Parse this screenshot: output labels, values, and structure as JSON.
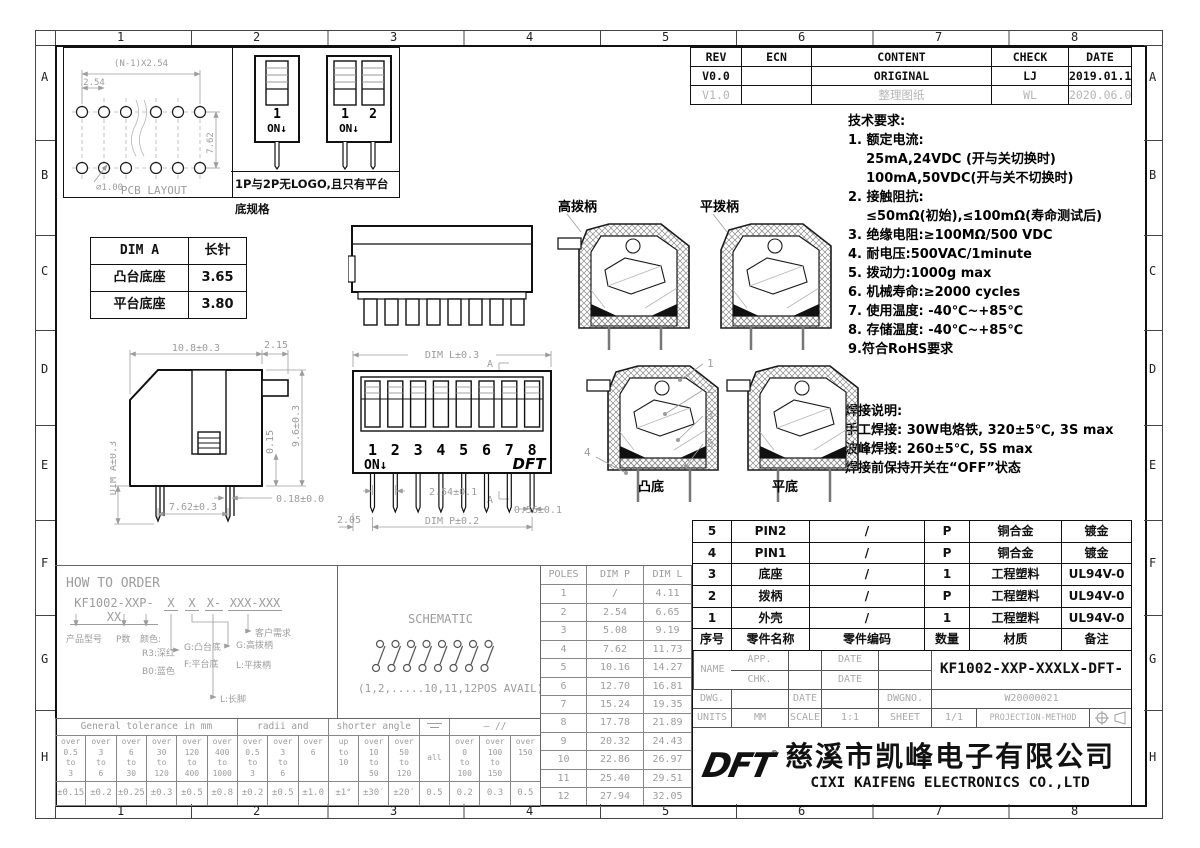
{
  "frame": {
    "cols": [
      "1",
      "2",
      "3",
      "4",
      "5",
      "6",
      "7",
      "8"
    ],
    "rows": [
      "A",
      "B",
      "C",
      "D",
      "E",
      "F",
      "G",
      "H"
    ]
  },
  "revision_table": {
    "headers": [
      "REV",
      "ECN",
      "CONTENT",
      "CHECK",
      "DATE"
    ],
    "rows": [
      {
        "rev": "V0.0",
        "ecn": "",
        "content": "ORIGINAL",
        "check": "LJ",
        "date": "2019.01.13"
      },
      {
        "rev": "V1.0",
        "ecn": "",
        "content": "整理图纸",
        "check": "WL",
        "date": "2020.06.03"
      }
    ]
  },
  "pcb_layout": {
    "dim_span": "(N-1)X2.54",
    "dim_pitch": "2.54",
    "dim_row": "7.62",
    "dim_hole": "⌀1.00",
    "caption": "PCB LAYOUT"
  },
  "mini_switches": {
    "sw1_num": "1",
    "sw2_num1": "1",
    "sw2_num2": "2",
    "on_label": "ON↓",
    "note": "1P与2P无LOGO,且只有平台底规格"
  },
  "dim_a_table": {
    "h1": "DIM A",
    "h2": "长针",
    "rows": [
      [
        "凸台底座",
        "3.65"
      ],
      [
        "平台底座",
        "3.80"
      ]
    ]
  },
  "tech": {
    "title": "技术要求:",
    "lines": [
      "1. 额定电流:",
      "    25mA,24VDC (开与关切换时)",
      "    100mA,50VDC(开与关不切换时)",
      "2. 接触阻抗:",
      "    ≤50mΩ(初始),≤100mΩ(寿命测试后)",
      "3. 绝缘电阻:≥100MΩ/500 VDC",
      "4. 耐电压:500VAC/1minute",
      "5. 拨动力:1000g max",
      "6. 机械寿命:≥2000 cycles",
      "7. 使用温度: -40℃~+85℃",
      "8. 存储温度: -40℃~+85℃",
      "9.符合RoHS要求"
    ]
  },
  "solder": {
    "title": "焊接说明:",
    "lines": [
      "手工焊接: 30W电烙铁, 320±5℃, 3S max",
      "波峰焊接: 260±5℃, 5S max",
      "焊接前保持开关在“OFF”状态"
    ]
  },
  "sections": {
    "high_label": "高拨柄",
    "flat_label": "平拨柄",
    "convex_label": "凸底",
    "flatbottom_label": "平底",
    "callouts": [
      "1",
      "2",
      "3",
      "4",
      "5"
    ]
  },
  "side_view": {
    "d_width": "10.8±0.3",
    "d_stub": "2.15",
    "d_height": "9.6±0.3",
    "d_step": "0.15",
    "d_pin_t": "0.18±0.05",
    "d_pitch": "7.62±0.3",
    "d_pinlen": "DIM A±0.3"
  },
  "front_view": {
    "top_dim": "DIM L±0.3",
    "positions": [
      "1",
      "2",
      "3",
      "4",
      "5",
      "6",
      "7",
      "8"
    ],
    "on_label": "ON↓",
    "section_a": "A",
    "pitch_dim": "2.54±0.1",
    "pin_w_dim": "0.56±0.1",
    "p_dim": "DIM P±0.2",
    "left_dim": "2.05",
    "logo": "DFT"
  },
  "bom": {
    "headers": [
      "序号",
      "零件名称",
      "零件编码",
      "数量",
      "材质",
      "备注"
    ],
    "rows": [
      [
        "5",
        "PIN2",
        "/",
        "P",
        "铜合金",
        "镀金"
      ],
      [
        "4",
        "PIN1",
        "/",
        "P",
        "铜合金",
        "镀金"
      ],
      [
        "3",
        "底座",
        "/",
        "1",
        "工程塑料",
        "UL94V-0"
      ],
      [
        "2",
        "拨柄",
        "/",
        "P",
        "工程塑料",
        "UL94V-0"
      ],
      [
        "1",
        "外壳",
        "/",
        "1",
        "工程塑料",
        "UL94V-0"
      ]
    ]
  },
  "poles_table": {
    "headers": [
      "POLES",
      "DIM P",
      "DIM L"
    ],
    "rows": [
      [
        "1",
        "/",
        "4.11"
      ],
      [
        "2",
        "2.54",
        "6.65"
      ],
      [
        "3",
        "5.08",
        "9.19"
      ],
      [
        "4",
        "7.62",
        "11.73"
      ],
      [
        "5",
        "10.16",
        "14.27"
      ],
      [
        "6",
        "12.70",
        "16.81"
      ],
      [
        "7",
        "15.24",
        "19.35"
      ],
      [
        "8",
        "17.78",
        "21.89"
      ],
      [
        "9",
        "20.32",
        "24.43"
      ],
      [
        "10",
        "22.86",
        "26.97"
      ],
      [
        "11",
        "25.40",
        "29.51"
      ],
      [
        "12",
        "27.94",
        "32.05"
      ]
    ]
  },
  "how_to_order": {
    "title": "HOW TO ORDER",
    "code": "KF1002-XXP-XX",
    "x1": "X",
    "x2": "X",
    "x3": "X-",
    "x4": "XXX-XXX",
    "lbl_model": "产品型号",
    "lbl_p": "P数",
    "lbl_color": "颜色:",
    "color1": "R3:深红",
    "color2": "B0:蓝色",
    "base1": "G:凸台底",
    "base2": "F:平台底",
    "act1": "G:高拨柄",
    "act2": "L:平拨柄",
    "pin": "L:长脚",
    "cust": "客户需求"
  },
  "schematic": {
    "title": "SCHEMATIC",
    "caption": "(1,2,.....10,11,12POS AVAIL)"
  },
  "title_block": {
    "app": "APP.",
    "chk": "CHK.",
    "dwg": "DWG.",
    "date": "DATE",
    "name_label": "NAME",
    "name_value": "KF1002-XXP-XXXLX-DFT-XXX",
    "dwgno_label": "DWGNO.",
    "dwgno_value": "W20000021",
    "units_label": "UNITS",
    "units_value": "MM",
    "scale_label": "SCALE",
    "scale_value": "1:1",
    "sheet_label": "SHEET",
    "sheet_value": "1/1",
    "projection_label": "PROJECTION-METHOD",
    "logo": "DFT",
    "reg": "®",
    "company_cn": "慈溪市凯峰电子有限公司",
    "company_en": "CIXI KAIFENG ELECTRONICS CO.,LTD"
  },
  "tolerance": {
    "sec1": "General tolerance in mm",
    "sec2": "radii and chamfers",
    "sec3": "shorter angle side",
    "sec5": "—  //",
    "cols": [
      {
        "r": "over\n0.5\nto\n3",
        "v": "±0.15"
      },
      {
        "r": "over\n3\nto\n6",
        "v": "±0.2"
      },
      {
        "r": "over\n6\nto\n30",
        "v": "±0.25"
      },
      {
        "r": "over\n30\nto\n120",
        "v": "±0.3"
      },
      {
        "r": "over\n120\nto\n400",
        "v": "±0.5"
      },
      {
        "r": "over\n400\nto\n1000",
        "v": "±0.8"
      },
      {
        "r": "over\n0.5\nto\n3",
        "v": "±0.2"
      },
      {
        "r": "over\n3\nto\n6",
        "v": "±0.5"
      },
      {
        "r": "over\n6",
        "v": "±1.0"
      },
      {
        "r": "up\nto\n10",
        "v": "±1°"
      },
      {
        "r": "over\n10\nto\n50",
        "v": "±30′"
      },
      {
        "r": "over\n50\nto\n120",
        "v": "±20′"
      },
      {
        "r": "all",
        "v": "0.5"
      },
      {
        "r": "over\n0\nto\n100",
        "v": "0.2"
      },
      {
        "r": "over\n100\nto\n150",
        "v": "0.3"
      },
      {
        "r": "over\n150",
        "v": "0.5"
      }
    ]
  }
}
